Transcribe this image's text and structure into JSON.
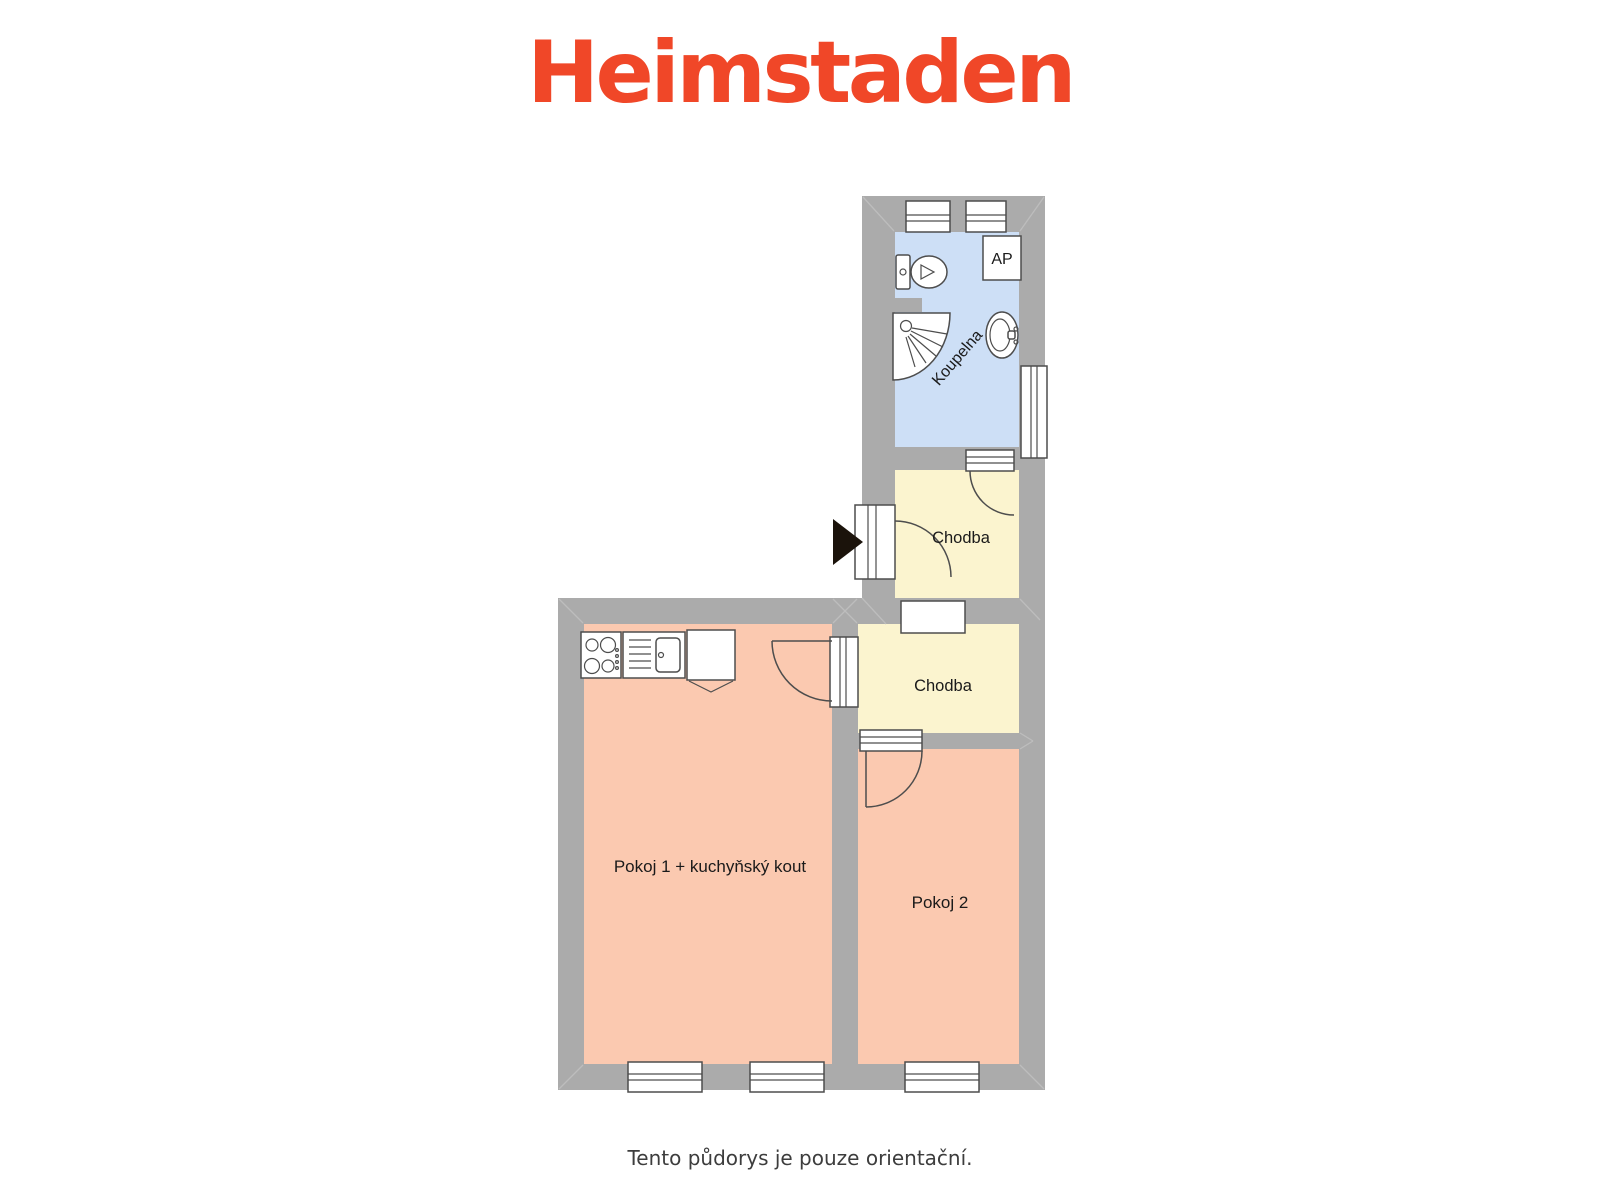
{
  "logo": {
    "text": "Heimstaden",
    "color": "#F04728"
  },
  "floor_plan": {
    "wall_color": "#ABABAB",
    "rooms": [
      {
        "id": "koupelna",
        "label": "Koupelna",
        "color": "#CDDFF6"
      },
      {
        "id": "chodba-upper",
        "label": "Chodba",
        "color": "#FBF4CF"
      },
      {
        "id": "chodba-lower",
        "label": "Chodba",
        "color": "#FBF4CF"
      },
      {
        "id": "pokoj-1",
        "label": "Pokoj 1 + kuchyňský kout",
        "color": "#FBC9B0"
      },
      {
        "id": "pokoj-2",
        "label": "Pokoj 2",
        "color": "#FBC9B0"
      }
    ],
    "ap_label": "AP",
    "fixtures": [
      "toilet",
      "shower",
      "washbasin",
      "stove",
      "kitchen-sink",
      "cabinet"
    ],
    "windows_count": 6,
    "entrance": "arrow-left-wall"
  },
  "caption": {
    "text": "Tento půdorys je pouze orientační."
  }
}
